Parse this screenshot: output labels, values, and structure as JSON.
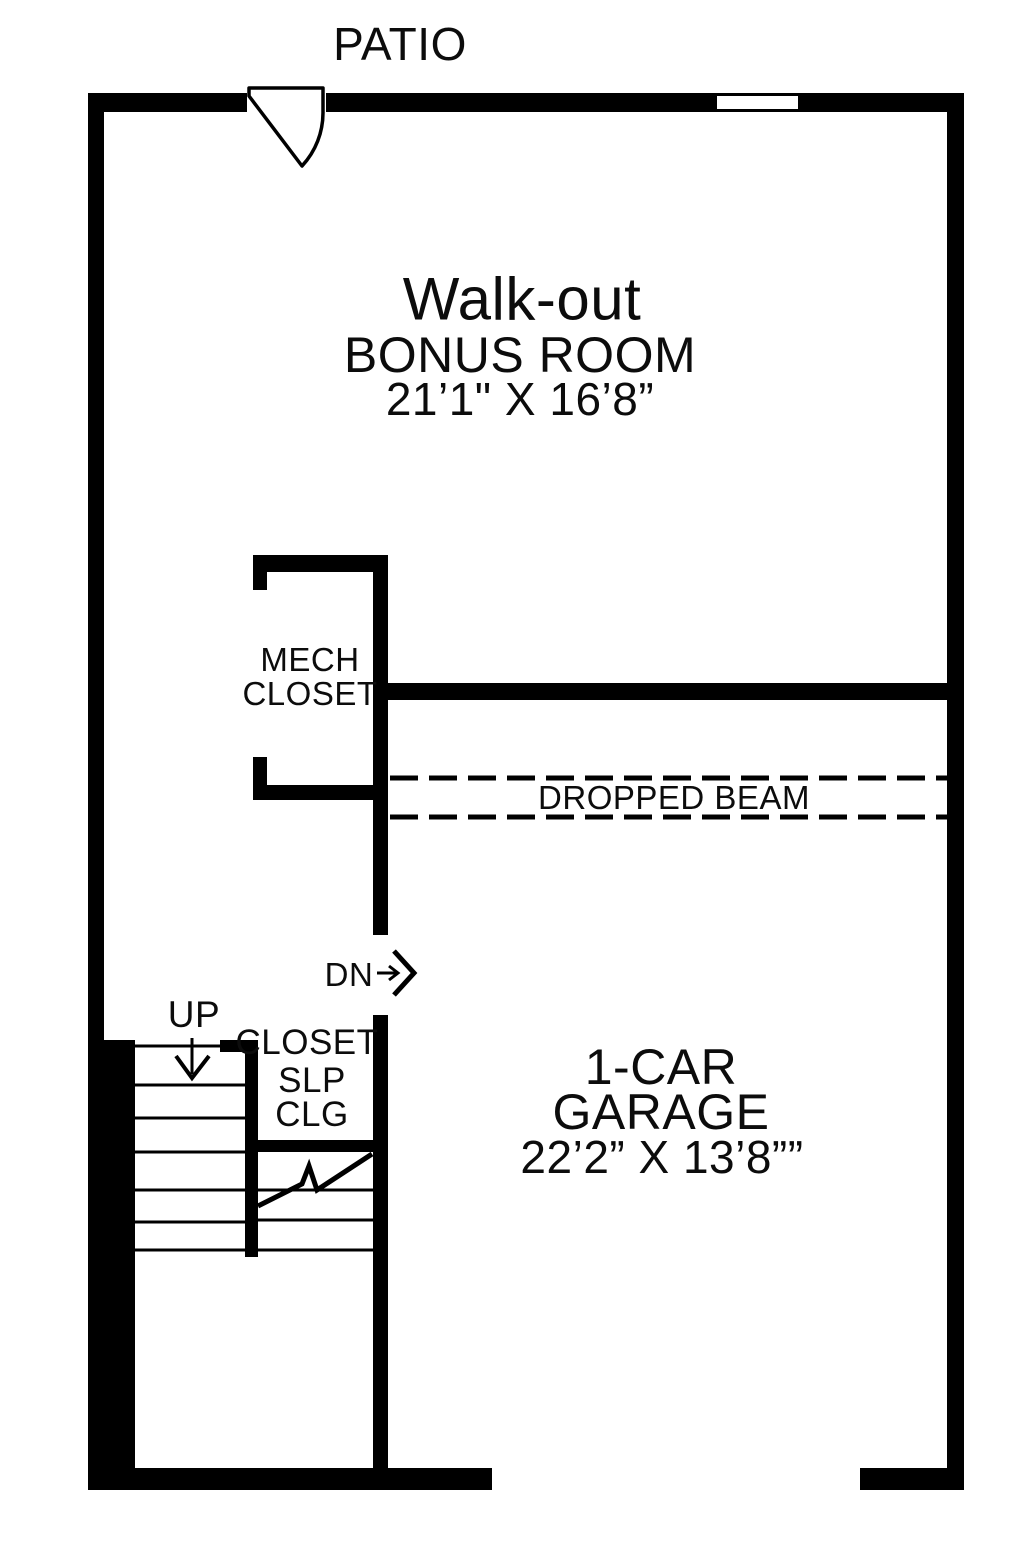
{
  "plan": {
    "patio_label": "PATIO",
    "bonus_room": {
      "line1": "Walk-out",
      "line2": "BONUS ROOM",
      "dims": "21’1\" X 16’8”"
    },
    "mech_closet": {
      "line1": "MECH",
      "line2": "CLOSET"
    },
    "dropped_beam_label": "DROPPED BEAM",
    "stairs": {
      "up_label": "UP",
      "dn_label": "DN"
    },
    "under_stair_closet": {
      "line1": "CLOSET",
      "line2": "SLP",
      "line3": "CLG"
    },
    "garage": {
      "line1": "1-CAR",
      "line2": "GARAGE",
      "dims": "22’2” X 13’8””"
    },
    "colors": {
      "wall": "#000000",
      "background": "#ffffff",
      "line": "#000000"
    }
  }
}
